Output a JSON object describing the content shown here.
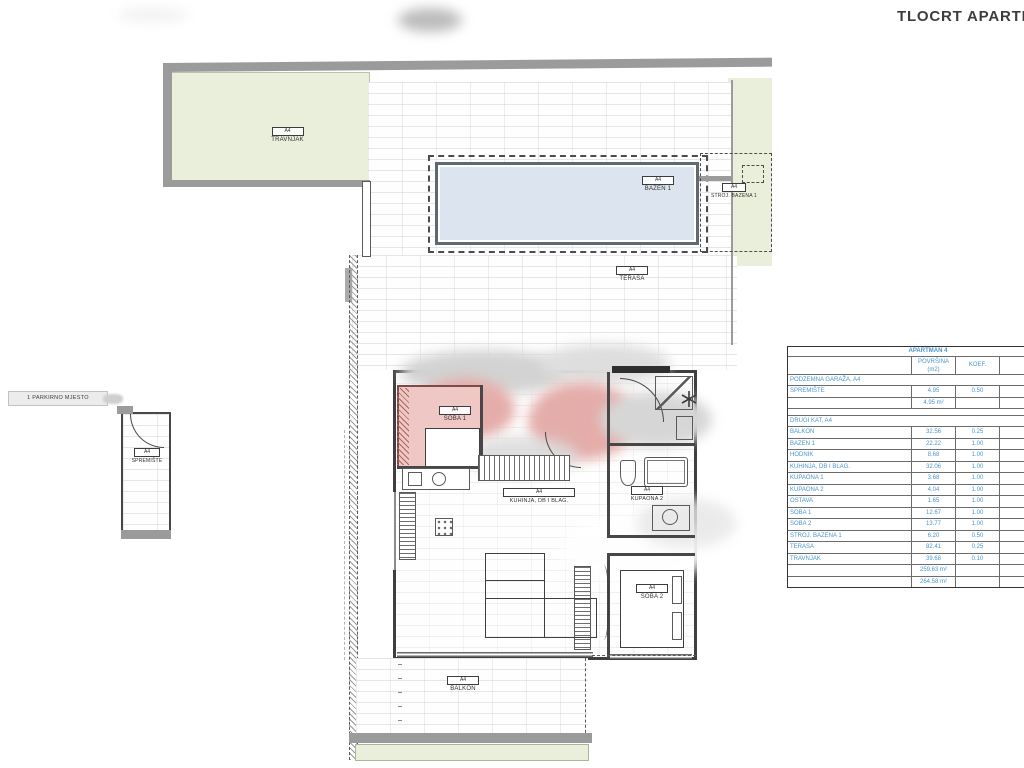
{
  "page": {
    "title": "TLOCRT APARTI"
  },
  "plan": {
    "parking_label": "1 PARKIRNO MJESTO",
    "unit_code": "A4",
    "labels": {
      "travnjak": {
        "code": "A4",
        "name": "TRAVNJAK"
      },
      "bazen": {
        "code": "A4",
        "name": "BAZEN 1"
      },
      "stroj": {
        "code": "A4",
        "name": "STROJ. BAZENA 1"
      },
      "terasa": {
        "code": "A4",
        "name": "TERASA"
      },
      "spremiste": {
        "code": "A4",
        "name": "SPREMIŠTE"
      },
      "soba1": {
        "code": "A4",
        "name": "SOBA 1"
      },
      "kuhinja": {
        "code": "A4",
        "name": "KUHINJA, DB I BLAG."
      },
      "kupaona2": {
        "code": "A4",
        "name": "KUPAONA 2"
      },
      "soba2": {
        "code": "A4",
        "name": "SOBA 2"
      },
      "balkon": {
        "code": "A4",
        "name": "BALKON"
      }
    },
    "colors": {
      "lawn": "#e9efda",
      "pool": "#dce5ef",
      "room_pink": "#e4adaa",
      "wall_gray": "#9b9b9b",
      "table_text": "#4a96cc"
    }
  },
  "table": {
    "title": "APARTMAN 4",
    "headers": {
      "area_line1": "POVRŠINA",
      "area_line2": "(m2)",
      "koef": "KOEF.",
      "cut_line1": "PO",
      "cut_line2": "KO"
    },
    "section1": {
      "title": "PODZEMNA GARAŽA, A4",
      "rows": [
        {
          "name": "SPREMIŠTE",
          "area": "4.95",
          "koef": "0.50"
        }
      ],
      "subtotal": "4.95 m²",
      "subtotal_cut": "1"
    },
    "section2": {
      "title": "DRUGI KAT, A4",
      "rows": [
        {
          "name": "BALKON",
          "area": "32.56",
          "koef": "0.25"
        },
        {
          "name": "BAZEN 1",
          "area": "22.22",
          "koef": "1.00"
        },
        {
          "name": "HODNIK",
          "area": "8.68",
          "koef": "1.00"
        },
        {
          "name": "KUHINJA, DB I BLAG.",
          "area": "32.06",
          "koef": "1.00"
        },
        {
          "name": "KUPAONA 1",
          "area": "3.68",
          "koef": "1.00"
        },
        {
          "name": "KUPAONA 2",
          "area": "4.04",
          "koef": "1.00"
        },
        {
          "name": "OSTAVA",
          "area": "1.65",
          "koef": "1.00"
        },
        {
          "name": "SOBA 1",
          "area": "12.67",
          "koef": "1.00"
        },
        {
          "name": "SOBA 2",
          "area": "13.77",
          "koef": "1.00"
        },
        {
          "name": "STROJ. BAZENA 1",
          "area": "6.20",
          "koef": "0.50"
        },
        {
          "name": "TERASA",
          "area": "82.41",
          "koef": "0.25"
        },
        {
          "name": "TRAVNJAK",
          "area": "39.68",
          "koef": "0.10"
        }
      ]
    },
    "totals": [
      {
        "value": "259.63 m²",
        "cut": "1"
      },
      {
        "value": "264.58 m²",
        "cut": "1"
      }
    ]
  }
}
